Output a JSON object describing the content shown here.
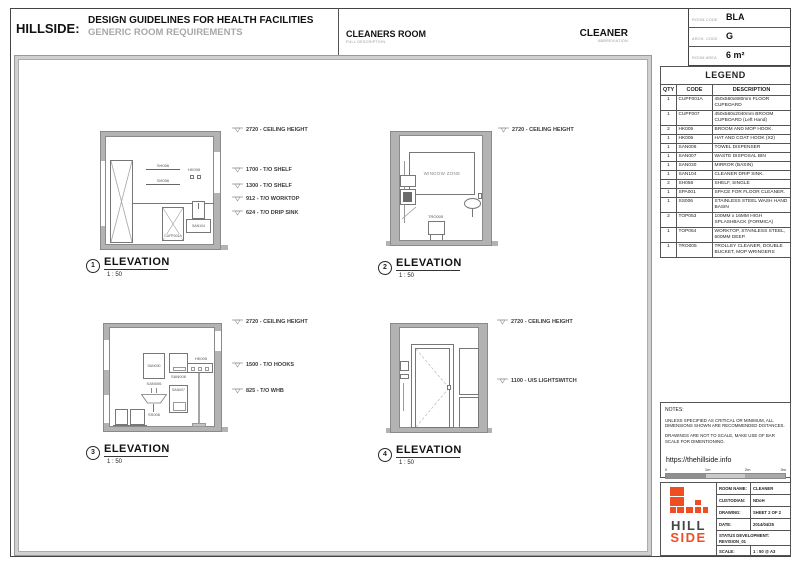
{
  "header": {
    "brand": "HILLSIDE:",
    "title": "DESIGN GUIDELINES FOR HEALTH FACILITIES",
    "subtitle": "GENERIC ROOM REQUIREMENTS",
    "room_full": "CLEANERS ROOM",
    "room_full_sub": "FULL DESCRIPTION",
    "room_abbr": "CLEANER",
    "room_abbr_sub": "ABBREVIATION"
  },
  "room_info": {
    "rows": [
      {
        "label": "ROOM CODE",
        "value": "BLA"
      },
      {
        "label": "ARCH. CODE",
        "value": "G"
      },
      {
        "label": "ROOM AREA",
        "value": "6 m²"
      }
    ]
  },
  "legend": {
    "title": "LEGEND",
    "columns": [
      "QTY",
      "CODE",
      "DESCRIPTION"
    ],
    "rows": [
      [
        "1",
        "CUPF001A",
        "450x560x880mm FLOOR CUPBOARD"
      ],
      [
        "1",
        "CUPF007",
        "450x560x2040mm BROOM CUPBOARD (Left Hand)"
      ],
      [
        "2",
        "HK005",
        "BROOM AND MOP HOOK."
      ],
      [
        "1",
        "HK006",
        "HAT AND COAT HOOK (X2)"
      ],
      [
        "1",
        "SAN006",
        "TOWEL DISPENSER"
      ],
      [
        "1",
        "SAN007",
        "WASTE DISPOSAL BIN"
      ],
      [
        "1",
        "SAN030",
        "MIRROR (BASIN)"
      ],
      [
        "1",
        "SAN104",
        "CLEANER DRIP SINK."
      ],
      [
        "2",
        "SH056",
        "SHELF, SINGLE"
      ],
      [
        "1",
        "SPA001",
        "SPACE FOR FLOOR CLEANER."
      ],
      [
        "1",
        "SS006",
        "STAINLESS STEEL WASH HAND BASIN"
      ],
      [
        "2",
        "TOP053",
        "100MM x 16MM HIGH SPLASHBACK (FORMICA)"
      ],
      [
        "1",
        "TOP064",
        "WORKTOP, STAINLESS STEEL, 600MM DEEP."
      ],
      [
        "1",
        "TRO005",
        "TROLLEY CLEANER, DOUBLE BUCKET, MOP WRINGERS"
      ]
    ]
  },
  "elevations": [
    {
      "number": "1",
      "title": "ELEVATION",
      "scale": "1 : 50",
      "callouts": [
        "2720 - CEILING HEIGHT",
        "1700 - T/O SHELF",
        "1300 - T/O SHELF",
        "912 - T/O WORKTOP",
        "624 - T/O DRIP SINK"
      ],
      "labels": {
        "shelf_upper": "SH056",
        "shelf_lower": "SH056",
        "hooks": "HK006",
        "floor_cupboard": "CUPF001A",
        "drip_sink": "SAN104"
      }
    },
    {
      "number": "2",
      "title": "ELEVATION",
      "scale": "1 : 50",
      "callouts": [
        "2720 - CEILING HEIGHT"
      ],
      "labels": {
        "window_zone": "WINDOW ZONE",
        "trolley": "TRO005"
      }
    },
    {
      "number": "3",
      "title": "ELEVATION",
      "scale": "1 : 50",
      "callouts": [
        "2720 - CEILING HEIGHT",
        "1500 - T/O HOOKS",
        "825 - T/O WHB"
      ],
      "labels": {
        "mirror": "SAN030",
        "towel_dispenser": "SAN006",
        "wash_basin": "SS006",
        "dispenser": "SAN006",
        "waste_bin": "SAN007",
        "hooks": "HK005"
      }
    },
    {
      "number": "4",
      "title": "ELEVATION",
      "scale": "1 : 50",
      "callouts": [
        "2720 - CEILING HEIGHT",
        "1100 - U/S LIGHTSWITCH"
      ],
      "labels": {}
    }
  ],
  "notes": {
    "heading": "NOTES:",
    "line1": "UNLESS SPECIFIED AS CRITICAL OR MINIMUM, ALL DIMENSIONS SHOWN ARE RECOMMENDED DISTANCES.",
    "line2": "DRAWINGS ARE NOT TO SCALE, MAKE USE OF BAR SCALE FOR DIMENTIONING.",
    "url": "https://thehillside.info",
    "scale_ticks": [
      "0",
      "1m",
      "2m",
      "3m"
    ]
  },
  "title_block": {
    "logo_line1": "HILL",
    "logo_line2": "SIDE",
    "rows": [
      {
        "label": "ROOM NAME:",
        "value": "CLEANER"
      },
      {
        "label": "CUSTODIAN:",
        "value": "NDoH"
      },
      {
        "label": "DRAWING:",
        "value": "SHEET 2 OF 2"
      },
      {
        "label": "DATE:",
        "value": "2014/04/25"
      }
    ],
    "status_label": "STATUS DEVELOPMENT:",
    "status_value": "REVISION_01",
    "scale_label": "SCALE:",
    "scale_value": "1 : 50 @ A3"
  },
  "colors": {
    "accent_orange": "#ef4e23",
    "wall_gray": "#b3b3b3"
  }
}
